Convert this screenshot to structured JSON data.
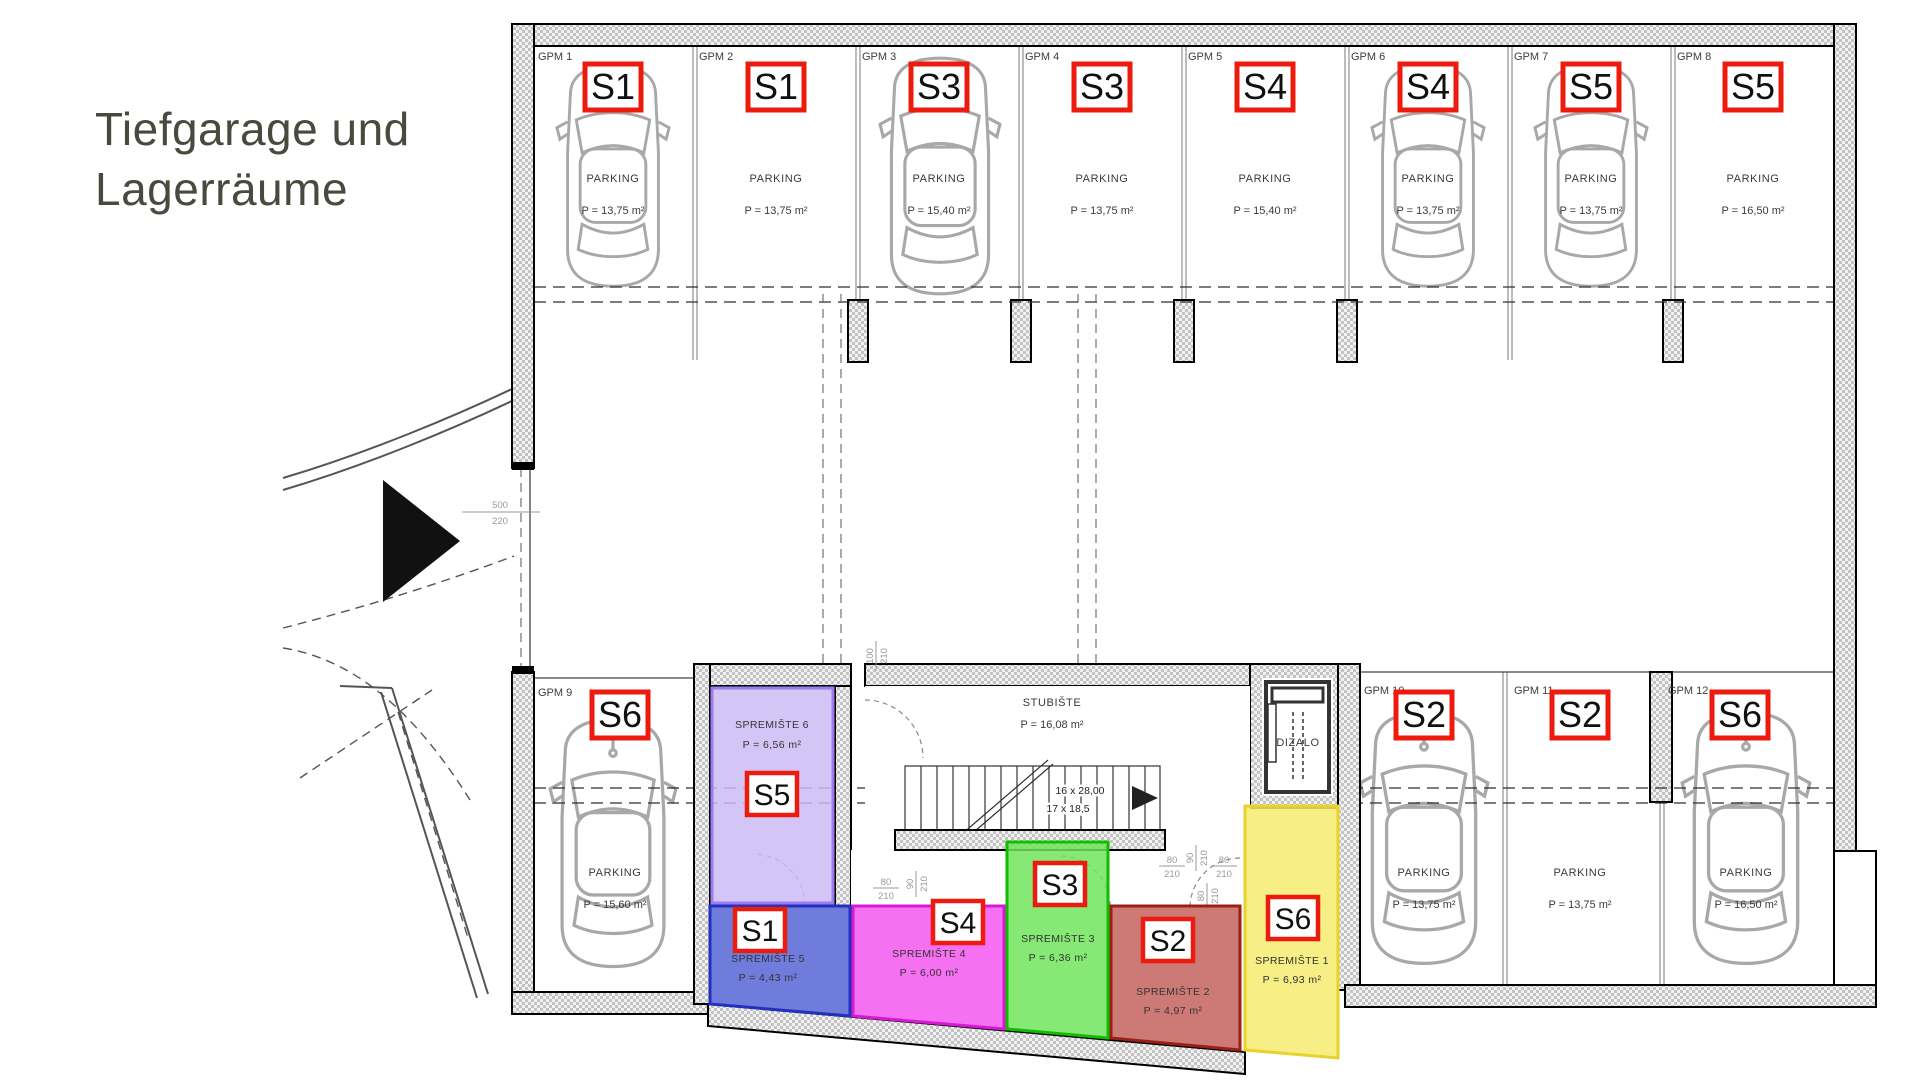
{
  "title": "Tiefgarage und\nLagerräume",
  "colors": {
    "badge_border": "#ed1b0e",
    "title_text": "#4a493e"
  },
  "parking_spots": [
    {
      "id": "GPM 1",
      "unit": "S1",
      "type_label": "PARKING",
      "area": "P = 13,75 m²",
      "has_car": true
    },
    {
      "id": "GPM 2",
      "unit": "S1",
      "type_label": "PARKING",
      "area": "P = 13,75 m²",
      "has_car": false
    },
    {
      "id": "GPM 3",
      "unit": "S3",
      "type_label": "PARKING",
      "area": "P = 15,40 m²",
      "has_car": true
    },
    {
      "id": "GPM 4",
      "unit": "S3",
      "type_label": "PARKING",
      "area": "P = 13,75 m²",
      "has_car": false
    },
    {
      "id": "GPM 5",
      "unit": "S4",
      "type_label": "PARKING",
      "area": "P = 15,40 m²",
      "has_car": false
    },
    {
      "id": "GPM 6",
      "unit": "S4",
      "type_label": "PARKING",
      "area": "P = 13,75 m²",
      "has_car": true
    },
    {
      "id": "GPM 7",
      "unit": "S5",
      "type_label": "PARKING",
      "area": "P = 13,75 m²",
      "has_car": true
    },
    {
      "id": "GPM 8",
      "unit": "S5",
      "type_label": "PARKING",
      "area": "P = 16,50 m²",
      "has_car": false
    },
    {
      "id": "GPM 9",
      "unit": "S6",
      "type_label": "PARKING",
      "area": "P = 15,60 m²",
      "has_car": true
    },
    {
      "id": "GPM 10",
      "unit": "S2",
      "type_label": "PARKING",
      "area": "P = 13,75 m²",
      "has_car": true
    },
    {
      "id": "GPM 11",
      "unit": "S2",
      "type_label": "PARKING",
      "area": "P = 13,75 m²",
      "has_car": false
    },
    {
      "id": "GPM 12",
      "unit": "S6",
      "type_label": "PARKING",
      "area": "P = 16,50 m²",
      "has_car": true
    }
  ],
  "storage_rooms": [
    {
      "name": "SPREMIŠTE 1",
      "unit": "S6",
      "area": "P = 6,93 m²",
      "fill": "#f6eb6e",
      "stroke": "#e7d22e"
    },
    {
      "name": "SPREMIŠTE 2",
      "unit": "S2",
      "area": "P = 4,97 m²",
      "fill": "#c4615c",
      "stroke": "#9c1f16"
    },
    {
      "name": "SPREMIŠTE 3",
      "unit": "S3",
      "area": "P = 6,36 m²",
      "fill": "#6fe45a",
      "stroke": "#12bc02"
    },
    {
      "name": "SPREMIŠTE 4",
      "unit": "S4",
      "area": "P = 6,00 m²",
      "fill": "#f455f0",
      "stroke": "#d619d2"
    },
    {
      "name": "SPREMIŠTE 5",
      "unit": "S1",
      "area": "P = 4,43 m²",
      "fill": "#5463d4",
      "stroke": "#2230bd"
    },
    {
      "name": "SPREMIŠTE 6",
      "unit": "S5",
      "area": "P = 6,56 m²",
      "fill": "#cbbaf3",
      "stroke": "#9a7cf0"
    }
  ],
  "stairwell": {
    "name": "STUBIŠTE",
    "area": "P = 16,08 m²",
    "flight_label_1": "16 x 28,00",
    "flight_label_2": "17 x 18,5"
  },
  "elevator": {
    "name": "DIZALO"
  },
  "dims": {
    "ramp": [
      "500",
      "220"
    ],
    "stair_door": [
      "100",
      "210"
    ],
    "door_a": [
      "80",
      "210"
    ],
    "door_b": [
      "90",
      "210"
    ]
  }
}
